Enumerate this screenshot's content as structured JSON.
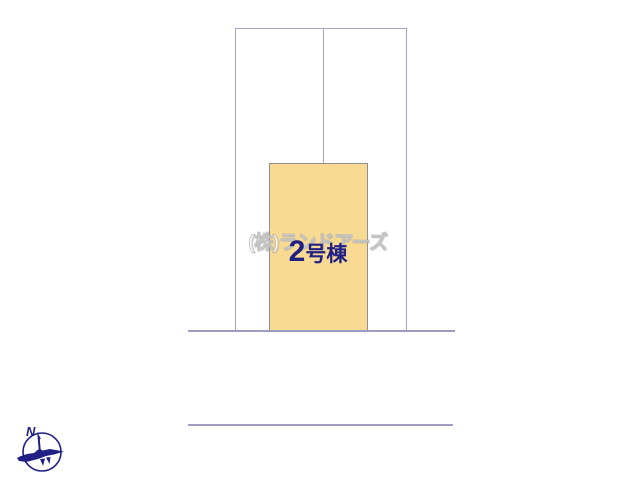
{
  "site_plan": {
    "watermark_text": "(株)ランドアーズ",
    "building_label": {
      "number": "2",
      "suffix": "号棟"
    },
    "compass": {
      "north_label": "N"
    },
    "colors": {
      "parcel_border": "#a6a6c8",
      "building_fill": "#f9da92",
      "building_border": "#8f8f8f",
      "road_line": "#9d9dc2",
      "label_text": "#1f1f85",
      "compass_color": "#1f1f85",
      "watermark_color": "#d9d9d9"
    }
  }
}
